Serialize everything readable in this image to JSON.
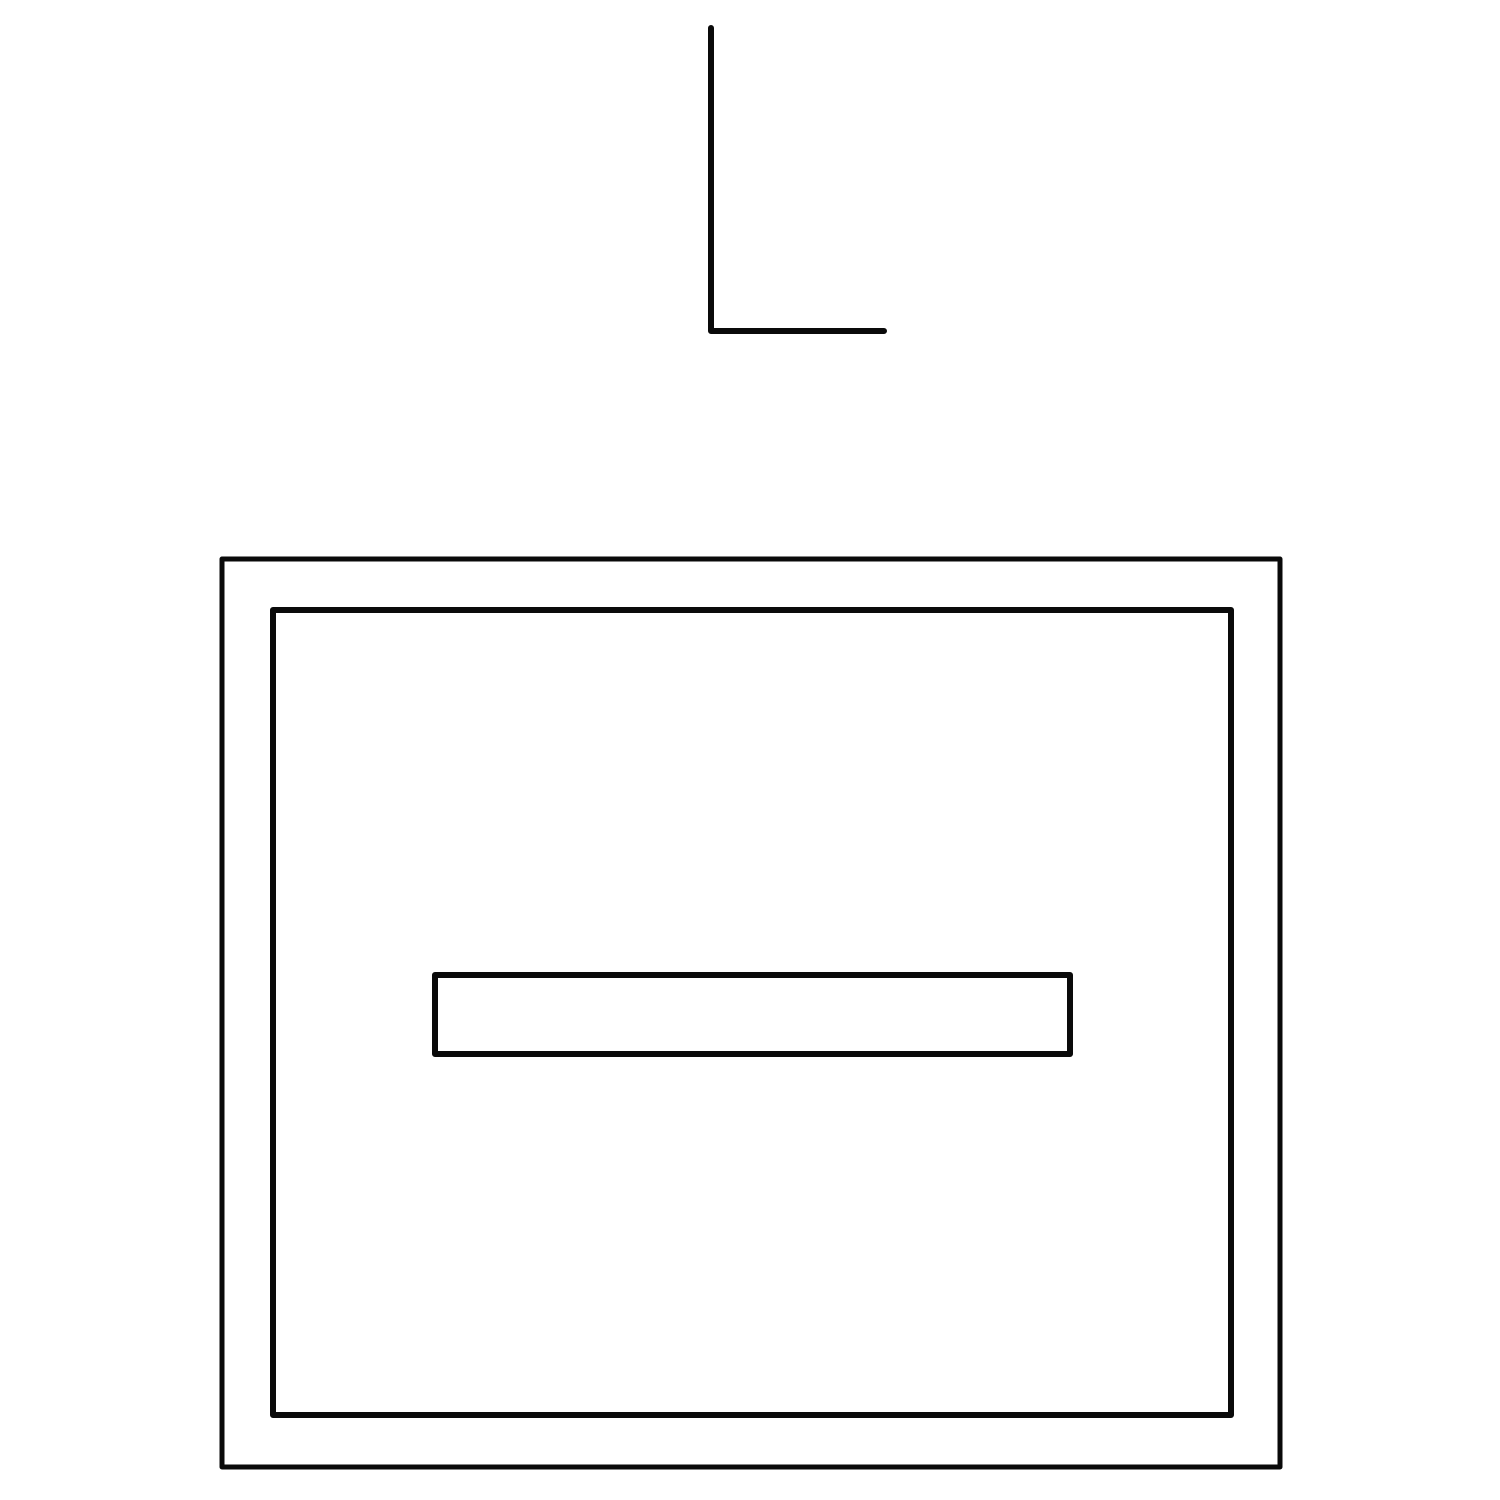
{
  "canvas": {
    "width": 1500,
    "height": 1500,
    "background_color": "#ffffff",
    "stroke_color": "#0a0a0a"
  },
  "shapes": [
    {
      "name": "l-shape-polyline",
      "type": "polyline",
      "points": [
        [
          711,
          28
        ],
        [
          711,
          331
        ],
        [
          884,
          331
        ]
      ],
      "stroke_width": 6
    },
    {
      "name": "outer-rectangle",
      "type": "rect",
      "x": 222,
      "y": 559,
      "width": 1058,
      "height": 908,
      "stroke_width": 5
    },
    {
      "name": "inner-rectangle",
      "type": "rect",
      "x": 273,
      "y": 610,
      "width": 958,
      "height": 805,
      "stroke_width": 6
    },
    {
      "name": "horizontal-bar-rectangle",
      "type": "rect",
      "x": 435,
      "y": 975,
      "width": 635,
      "height": 79,
      "stroke_width": 6
    }
  ]
}
